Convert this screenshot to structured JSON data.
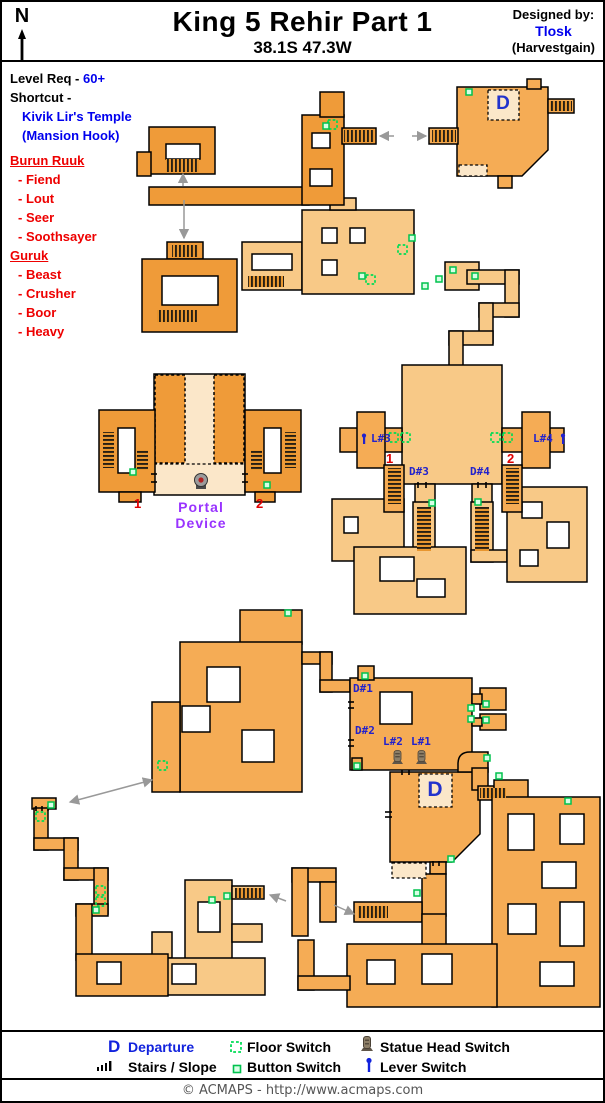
{
  "header": {
    "north": "N",
    "title": "King 5 Rehir Part 1",
    "coords": "38.1S 47.3W",
    "designed_by": "Designed by:",
    "designer": "Tlosk",
    "designer_server": "(Harvestgain)"
  },
  "info": {
    "level_req_label": "Level Req -",
    "level_req": "60+",
    "shortcut_label": "Shortcut -",
    "shortcut1": "Kivik Lir's Temple",
    "shortcut2": "(Mansion Hook)",
    "group1": "Burun Ruuk",
    "group1_members": [
      "- Fiend",
      "- Lout",
      "- Seer",
      "- Soothsayer"
    ],
    "group2": "Guruk",
    "group2_members": [
      "- Beast",
      "- Crusher",
      "- Boor",
      "- Heavy"
    ]
  },
  "map": {
    "d_top": "D",
    "d_bottom": "D",
    "l1": "L#1",
    "l2": "L#2",
    "l3": "L#3",
    "l4": "L#4",
    "d1": "D#1",
    "d2": "D#2",
    "d3": "D#3",
    "d4": "D#4",
    "portal1": "Portal",
    "portal2": "Device",
    "n1": "1",
    "n2": "2"
  },
  "legend": {
    "departure_icon": "D",
    "departure": "Departure",
    "floor_switch": "Floor Switch",
    "statue_head_switch": "Statue Head Switch",
    "stairs_slope": "Stairs / Slope",
    "button_switch": "Button Switch",
    "lever_switch": "Lever Switch"
  },
  "footer": {
    "credit": "© ACMAPS - http://www.acmaps.com"
  },
  "colors": {
    "room_deep": "#EF9B39",
    "room_mid": "#F5AC55",
    "room_light": "#F8C987",
    "room_cream": "#FBE7C9",
    "switch_green": "#00DD55",
    "label_blue": "#2222CC",
    "text_blue": "#0000EE",
    "text_red": "#EE0000",
    "portal_purple": "#9933FF"
  }
}
